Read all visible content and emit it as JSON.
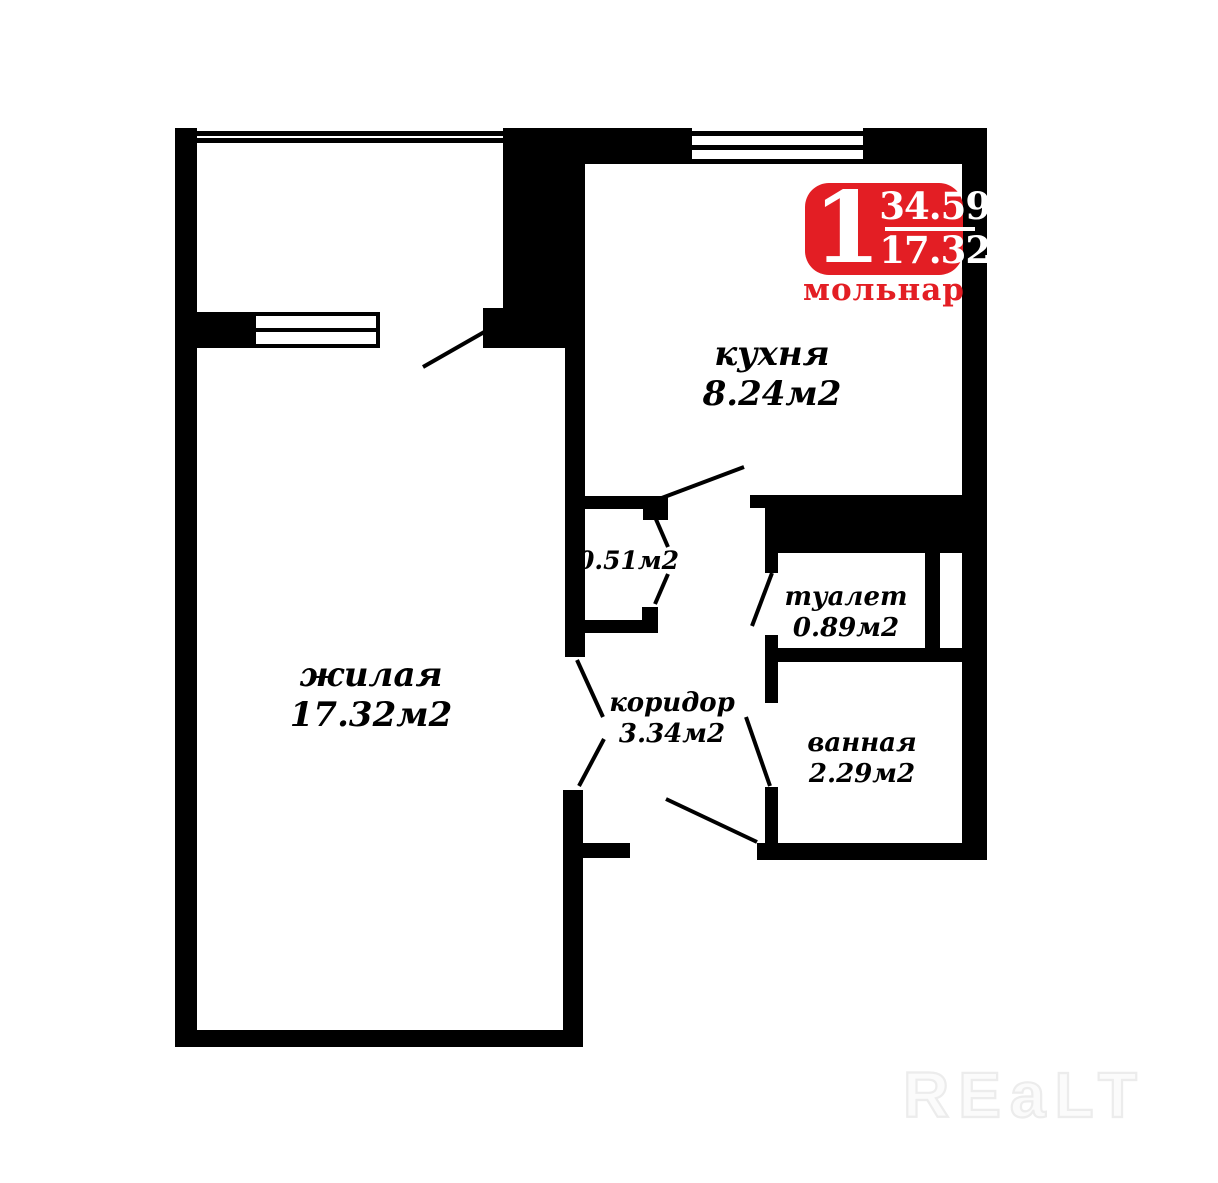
{
  "badge": {
    "rooms_count": "1",
    "area_total": "34.59",
    "area_living": "17.32",
    "brand": "мольнар"
  },
  "rooms": {
    "kitchen": {
      "name": "кухня",
      "area": "8.24м2"
    },
    "living": {
      "name": "жилая",
      "area": "17.32м2"
    },
    "closet": {
      "area": "0.51м2"
    },
    "corridor": {
      "name": "коридор",
      "area": "3.34м2"
    },
    "toilet": {
      "name": "туалет",
      "area": "0.89м2"
    },
    "bathroom": {
      "name": "ванная",
      "area": "2.29м2"
    }
  },
  "watermark": "REaLT",
  "colors": {
    "accent_red": "#e31e24",
    "wall": "#000000"
  }
}
